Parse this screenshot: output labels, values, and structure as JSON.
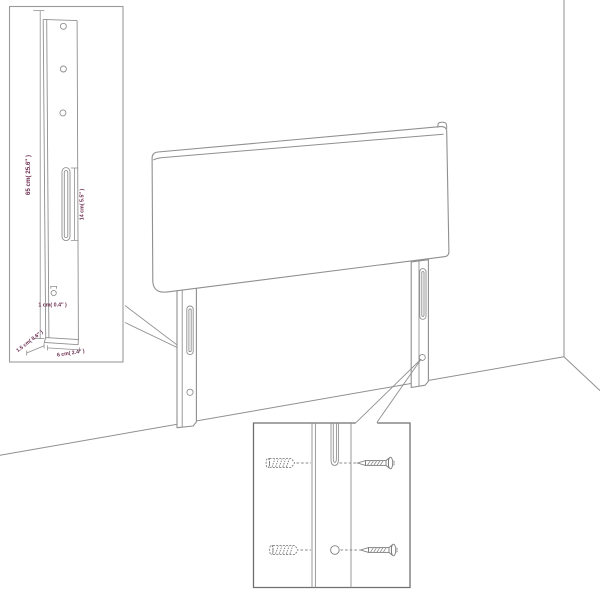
{
  "diagram": {
    "title_semantic": "headboard-wall-mount-diagram",
    "colors": {
      "line_gray": "#8f8f8f",
      "inset_border_gray": "#9b9b9b",
      "hardware_border_gray": "#6f6f6f",
      "dimension_text": "#6b2a4e",
      "background": "#ffffff"
    },
    "leg_detail_inset": {
      "height_label": "65 cm( 25.6″ )",
      "slot_height_label": "14 cm( 5.5″ )",
      "hole_width_label": "1 cm( 0.4″ )",
      "side_depth_label": "1.5 cm( 0.6″ )",
      "front_width_label": "6 cm( 2.4″ )"
    },
    "hardware_inset": {
      "icons": [
        "wall-anchor-icon",
        "screw-icon"
      ],
      "rows": 2
    }
  }
}
